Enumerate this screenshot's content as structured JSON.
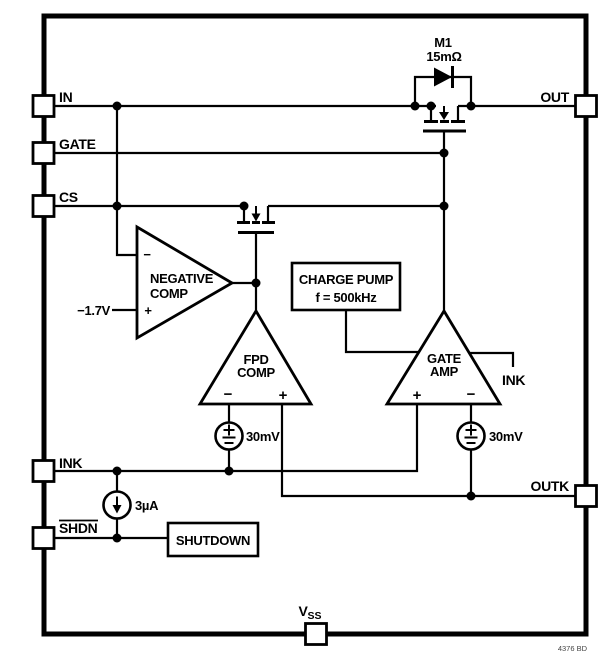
{
  "pins": {
    "in": "IN",
    "gate": "GATE",
    "cs": "CS",
    "ink": "INK",
    "shdn": "SHDN",
    "out": "OUT",
    "outk": "OUTK",
    "vss_v": "V",
    "vss_sub": "SS"
  },
  "m1": {
    "name": "M1",
    "rds": "15mΩ"
  },
  "negative_comp": {
    "line1": "NEGATIVE",
    "line2": "COMP",
    "minus": "−",
    "plus": "+",
    "ref": "−1.7V"
  },
  "fpd_comp": {
    "line1": "FPD",
    "line2": "COMP",
    "minus": "−",
    "plus": "+"
  },
  "gate_amp": {
    "line1": "GATE",
    "line2": "AMP",
    "plus": "+",
    "minus": "−",
    "ink_label": "INK"
  },
  "charge_pump": {
    "line1": "CHARGE PUMP",
    "line2": "f = 500kHz"
  },
  "shutdown": {
    "label": "SHUTDOWN"
  },
  "sources": {
    "offset_left": "30mV",
    "offset_right": "30mV",
    "bias": "3µA"
  },
  "footer": {
    "code": "4376 BD"
  },
  "symbols": {
    "voltage_source": "±",
    "current_source": "down-arrow",
    "body_diode": "diode-right"
  },
  "colors": {
    "ink": "#000000",
    "bg": "#ffffff"
  }
}
